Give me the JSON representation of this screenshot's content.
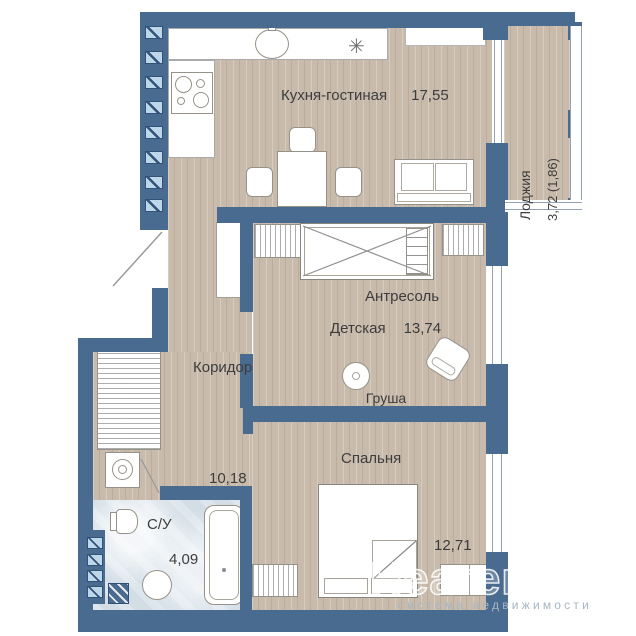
{
  "plan": {
    "rooms": {
      "kitchen_living": {
        "name": "Кухня-гостиная",
        "area": "17,55"
      },
      "loggia": {
        "name": "Лоджия",
        "area": "3,72 (1,86)"
      },
      "kids_room": {
        "name": "Детская",
        "area": "13,74",
        "mezzanine_label": "Антресоль",
        "pear_label": "Груша"
      },
      "corridor": {
        "name": "Коридор",
        "area": "10,18"
      },
      "bathroom": {
        "name": "С/У",
        "area": "4,09"
      },
      "bedroom": {
        "name": "Спальня",
        "area": "12,71"
      }
    },
    "icons": {
      "hob_star": "✳"
    },
    "colors": {
      "wall": "#4a6b90",
      "floor_wood": "#c9bbac",
      "floor_tile": "#d2dde6",
      "vent_square": "#bdd7ea",
      "text": "#3d3d3d"
    }
  },
  "watermark": {
    "brand": "Неагент",
    "tagline": "система недвижимости"
  }
}
